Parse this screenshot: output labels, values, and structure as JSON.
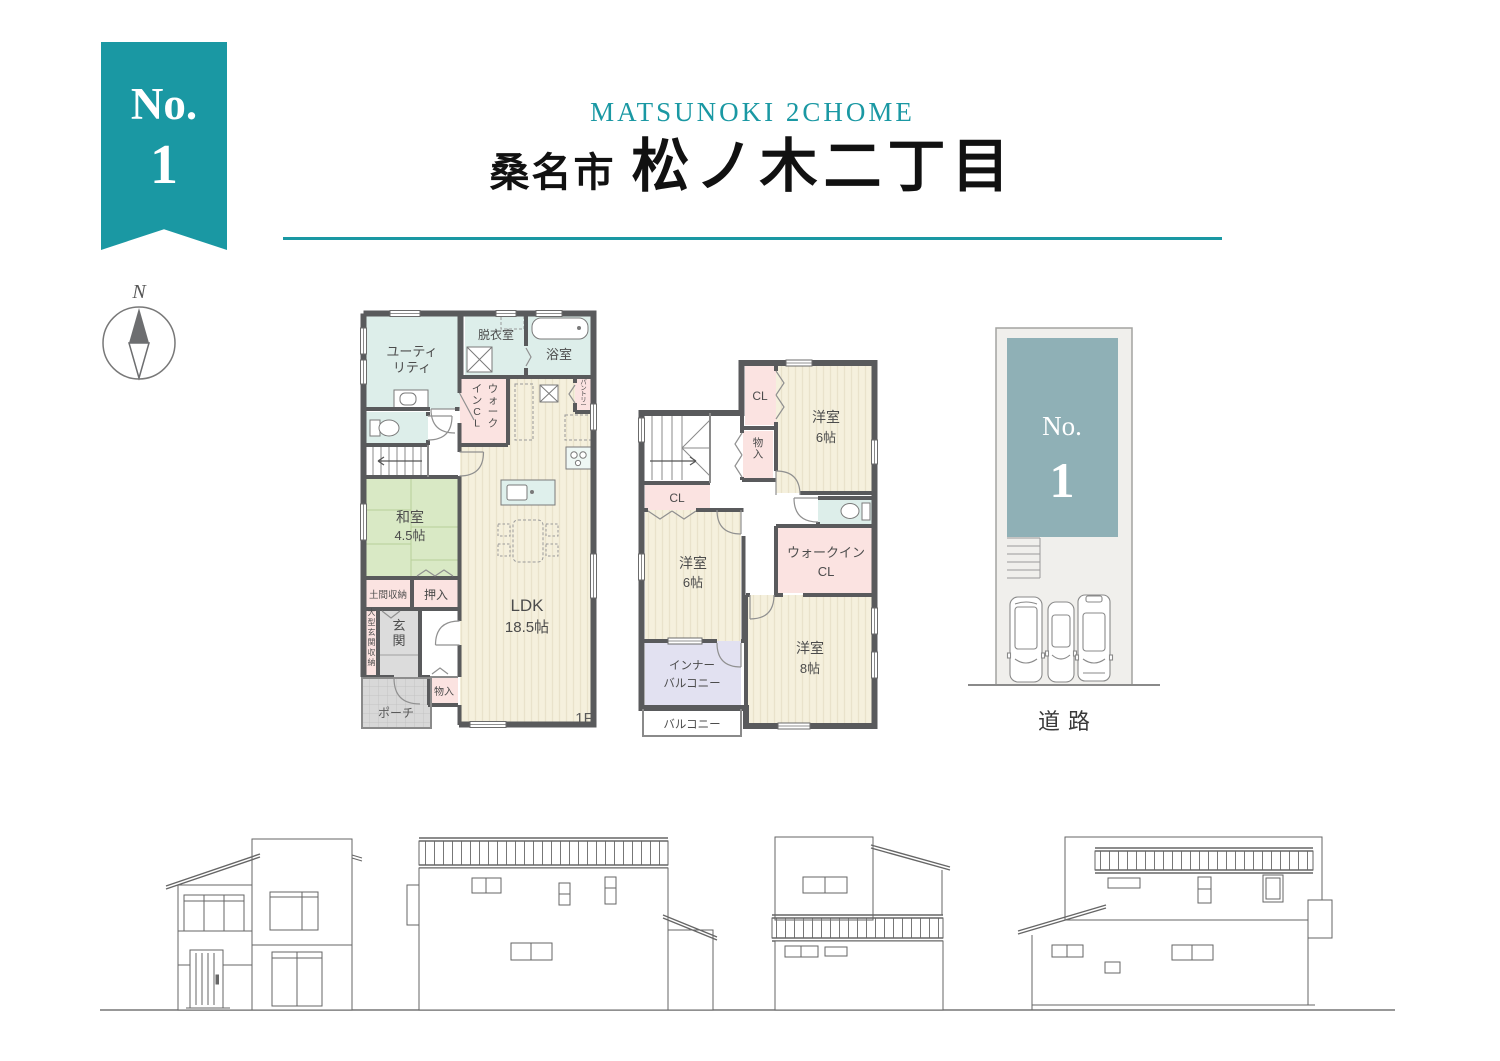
{
  "ribbon": {
    "prefix": "No.",
    "number": "1"
  },
  "compass": {
    "north_label": "N"
  },
  "header": {
    "subtitle": "MATSUNOKI 2CHOME",
    "title_city": "桑名市",
    "title_area": "松ノ木二丁目",
    "accent_color": "#1a98a3"
  },
  "floor1": {
    "floor_label": "1F",
    "rooms": {
      "utility_l1": "ユーティ",
      "utility_l2": "リティ",
      "dressing": "脱衣室",
      "bath": "浴室",
      "wic_col_right": "ウォーク",
      "wic_col_left": "インCL",
      "pantry": "パントリー",
      "japanese_l1": "和室",
      "japanese_l2": "4.5帖",
      "doma": "土間収納",
      "oshiire": "押入",
      "entrance_storage": "大型玄関収納",
      "entrance": "玄関",
      "storage": "物入",
      "porch": "ポーチ",
      "ldk_l1": "LDK",
      "ldk_l2": "18.5帖"
    }
  },
  "floor2": {
    "rooms": {
      "closet_a": "CL",
      "storage": "物入",
      "western6a_l1": "洋室",
      "western6a_l2": "6帖",
      "closet_b": "CL",
      "western6b_l1": "洋室",
      "western6b_l2": "6帖",
      "wic_l1": "ウォークイン",
      "wic_l2": "CL",
      "western8_l1": "洋室",
      "western8_l2": "8帖",
      "inner_balcony_l1": "インナー",
      "inner_balcony_l2": "バルコニー",
      "balcony": "バルコニー"
    }
  },
  "site_plan": {
    "lot_label_prefix": "No.",
    "lot_label_number": "1",
    "road_label": "道路"
  },
  "colors": {
    "accent_teal": "#1a98a3",
    "footprint_teal": "#8fb0b6",
    "wall_gray": "#595a5c",
    "room_cream": "#f5f0dd",
    "room_green": "#d9e9c5",
    "room_pink": "#fbe3e1",
    "room_blue": "#ddeeea",
    "room_lavender": "#e2e1f1"
  }
}
